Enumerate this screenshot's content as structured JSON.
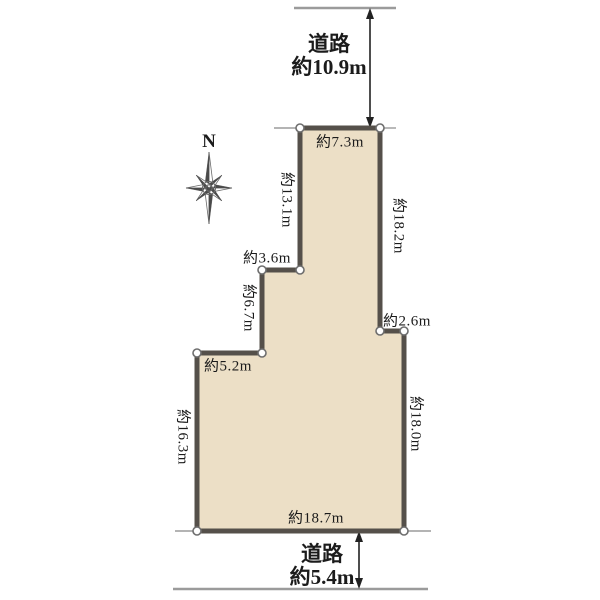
{
  "compass": {
    "label": "N"
  },
  "roads": {
    "top": {
      "name": "道路",
      "width": "約10.9m"
    },
    "bottom": {
      "name": "道路",
      "width": "約5.4m"
    }
  },
  "plot": {
    "edges": {
      "top": "約7.3m",
      "upper_left": "約13.1m",
      "step_left_horizontal": "約3.6m",
      "step_left_vertical": "約6.7m",
      "mid_left_horizontal": "約5.2m",
      "lower_left": "約16.3m",
      "bottom": "約18.7m",
      "lower_right": "約18.0m",
      "step_right_horizontal": "約2.6m",
      "upper_right": "約18.2m"
    }
  },
  "colors": {
    "plot_fill": "#ecdfc6",
    "plot_border": "#55504a",
    "road_line": "#9b9b9b",
    "arrow": "#222222",
    "text": "#1b1b1b"
  }
}
